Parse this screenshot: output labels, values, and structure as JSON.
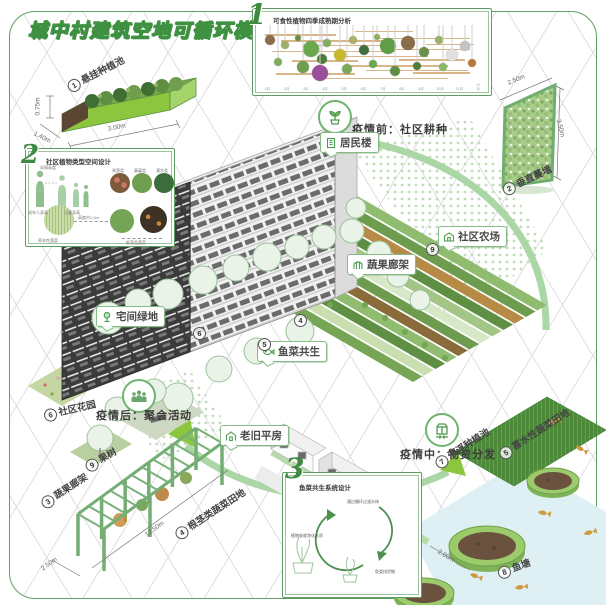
{
  "title": "城中村建筑空地可循环模块图",
  "frame_marks": [
    "×",
    "×",
    "×"
  ],
  "colors": {
    "accent": "#4f9a53",
    "band": "#abd6a5",
    "frame": "#5f9e62",
    "bar": "#d9b58a",
    "pond": "#def0f3"
  },
  "panel1": {
    "num": "1",
    "title": "可食性植物四季成熟期分析",
    "months": [
      "1月",
      "2月",
      "3月",
      "4月",
      "5月",
      "6月",
      "7月",
      "8月",
      "9月",
      "10月",
      "11月",
      "12月"
    ],
    "bubbles": [
      {
        "x": 3,
        "y": 26,
        "r": 5,
        "c": "#8a6b4a"
      },
      {
        "x": 10,
        "y": 34,
        "r": 4,
        "c": "#9cb06a"
      },
      {
        "x": 16,
        "y": 22,
        "r": 3,
        "c": "#6a8f4a"
      },
      {
        "x": 22,
        "y": 40,
        "r": 8,
        "c": "#69a84f"
      },
      {
        "x": 29,
        "y": 30,
        "r": 4,
        "c": "#7fae5e"
      },
      {
        "x": 27,
        "y": 58,
        "r": 5,
        "c": "#4e7d3a"
      },
      {
        "x": 35,
        "y": 50,
        "r": 6,
        "c": "#c8b830"
      },
      {
        "x": 41,
        "y": 26,
        "r": 4,
        "c": "#b0b06a"
      },
      {
        "x": 46,
        "y": 42,
        "r": 5,
        "c": "#3f6f3f"
      },
      {
        "x": 52,
        "y": 20,
        "r": 3,
        "c": "#8faf5f"
      },
      {
        "x": 57,
        "y": 36,
        "r": 8,
        "c": "#5e9e46"
      },
      {
        "x": 66,
        "y": 30,
        "r": 7,
        "c": "#8a6b4a"
      },
      {
        "x": 73,
        "y": 46,
        "r": 5,
        "c": "#6a8f4a"
      },
      {
        "x": 80,
        "y": 26,
        "r": 4,
        "c": "#9cb06a"
      },
      {
        "x": 86,
        "y": 50,
        "r": 6,
        "c": "#e0e0e0"
      },
      {
        "x": 92,
        "y": 36,
        "r": 5,
        "c": "#c4c4c4"
      },
      {
        "x": 18,
        "y": 72,
        "r": 6,
        "c": "#6f9e4f"
      },
      {
        "x": 26,
        "y": 82,
        "r": 8,
        "c": "#9a4f9a"
      },
      {
        "x": 38,
        "y": 74,
        "r": 5,
        "c": "#7aa85a"
      },
      {
        "x": 50,
        "y": 66,
        "r": 4,
        "c": "#69a84f"
      },
      {
        "x": 60,
        "y": 78,
        "r": 5,
        "c": "#5e8f43"
      },
      {
        "x": 70,
        "y": 70,
        "r": 4,
        "c": "#4e7d3a"
      },
      {
        "x": 7,
        "y": 62,
        "r": 4,
        "c": "#7fae5e"
      },
      {
        "x": 82,
        "y": 72,
        "r": 4,
        "c": "#8ab86a"
      },
      {
        "x": 95,
        "y": 64,
        "r": 4,
        "c": "#b87a3a"
      }
    ],
    "bars": [
      {
        "x": 1,
        "w": 32,
        "y": 16
      },
      {
        "x": 8,
        "w": 46,
        "y": 26
      },
      {
        "x": 24,
        "w": 36,
        "y": 34
      },
      {
        "x": 4,
        "w": 56,
        "y": 44
      },
      {
        "x": 33,
        "w": 42,
        "y": 52
      },
      {
        "x": 13,
        "w": 30,
        "y": 60
      },
      {
        "x": 38,
        "w": 46,
        "y": 68
      },
      {
        "x": 52,
        "w": 42,
        "y": 22
      },
      {
        "x": 58,
        "w": 36,
        "y": 40
      },
      {
        "x": 47,
        "w": 46,
        "y": 76
      },
      {
        "x": 6,
        "w": 36,
        "y": 82
      },
      {
        "x": 28,
        "w": 56,
        "y": 90
      },
      {
        "x": 62,
        "w": 30,
        "y": 58
      },
      {
        "x": 68,
        "w": 26,
        "y": 80
      },
      {
        "x": 42,
        "w": 26,
        "y": 10
      },
      {
        "x": 74,
        "w": 22,
        "y": 32
      }
    ]
  },
  "panel2": {
    "num": "2",
    "title": "社区植物类型空间设计",
    "notes": [
      "成年人身高",
      "儿童身高",
      "采摘高度",
      "果蔬类",
      "藤蔓类",
      "灌木类",
      "高度约1.2m",
      "草本性蔬菜",
      "根茎类蔬菜"
    ]
  },
  "panel3": {
    "num": "3",
    "title": "鱼菜共生系统设计",
    "cycle": [
      "通过循环过滤水体",
      "植物吸收净化水质",
      "鱼类排泄物"
    ]
  },
  "phases": [
    {
      "text": "疫情前：社区耕种"
    },
    {
      "text": "疫情后：聚会活动"
    },
    {
      "text": "疫情中：物资分发"
    }
  ],
  "callouts": [
    {
      "text": "居民楼"
    },
    {
      "text": "蔬果廊架"
    },
    {
      "text": "社区农场"
    },
    {
      "text": "宅间绿地"
    },
    {
      "text": "鱼菜共生"
    },
    {
      "text": "老旧平房"
    }
  ],
  "tags": [
    {
      "num": "1",
      "label": "悬挂种植池"
    },
    {
      "num": "2",
      "label": "垂直蔓墙"
    },
    {
      "num": "3",
      "label": "蔬果廊架"
    },
    {
      "num": "4",
      "label": "根茎类蔬菜田地"
    },
    {
      "num": "5",
      "label": "喜水性蔬菜田地"
    },
    {
      "num": "6",
      "label": "社区花园"
    },
    {
      "num": "7",
      "label": "漂浮种植池"
    },
    {
      "num": "8",
      "label": "鱼塘"
    },
    {
      "num": "9",
      "label": "果树"
    }
  ],
  "plan_nums": [
    "6",
    "5",
    "4",
    "9"
  ],
  "dims": [
    "0.75m",
    "1.40m",
    "3.00m",
    "2.50m",
    "3.50m",
    "12.50m",
    "2.50m",
    "2.00m"
  ]
}
